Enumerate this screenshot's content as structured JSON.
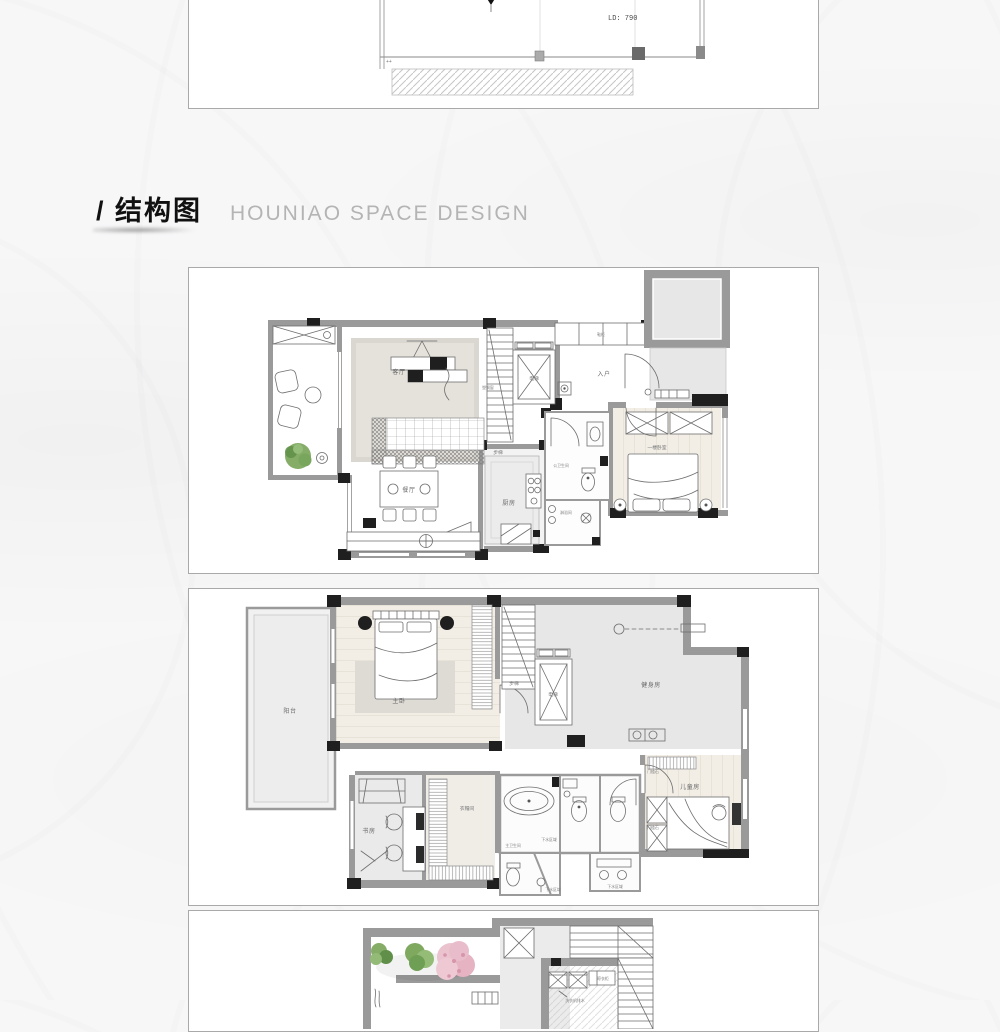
{
  "header": {
    "title": "/ 结构图",
    "subtitle": "HOUNIAO SPACE DESIGN"
  },
  "panel_top": {
    "ld_note": "LD: 790",
    "corner_marks": "++"
  },
  "floor1": {
    "living_room": "客厅",
    "dining_room": "餐厅",
    "kitchen": "厨房",
    "entry": "入户",
    "elevator": "电梯",
    "stairs": "步梯",
    "shoe_cabinet": "鞋柜",
    "window_note": "塑钢窗",
    "public_bathroom": "公卫生间",
    "shower_room": "淋浴间",
    "bedroom": "一楼卧室"
  },
  "floor2": {
    "balcony": "阳台",
    "master_bedroom": "主卧",
    "stairs": "步梯",
    "elevator": "电梯",
    "gym": "健身房",
    "kids_room": "儿童房",
    "study": "书房",
    "cloakroom": "衣帽间",
    "master_bathroom": "主卫生间",
    "drain_note_1": "下水区域",
    "drain_note_2": "下水区域",
    "drain_note_3": "下水区域",
    "threshold_1": "门槛石",
    "threshold_2": "门槛石"
  },
  "floor3": {
    "laundry_cabinet": "晾衣柜",
    "washer_drain": "洗衣机排水"
  },
  "colors": {
    "wall": "#9a9a9a",
    "dark": "#1f1f1f",
    "room": "#e7e7e7",
    "wood": "#f2eee6",
    "green": "#85ad68",
    "green2": "#5f8f49",
    "pink": "#eac3cf",
    "pink2": "#d795ab",
    "border": "#a9a9a9",
    "subtitle": "#b4b4b4"
  }
}
